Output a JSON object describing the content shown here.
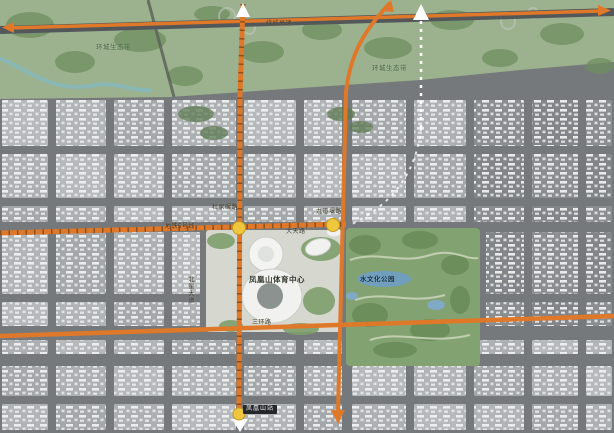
{
  "map": {
    "region_labels": {
      "eco_belt_west": "环城生态带",
      "eco_belt_east": "环城生态带",
      "sports_center": "凤凰山体育中心",
      "culture_park": "水文化公园"
    },
    "road_labels": {
      "ring_expressway": "绕城高速",
      "dujianian_road": "杜家碾路",
      "jiudaoyan_road": "九道堰路",
      "datian_road": "大天路",
      "beixing_avenue": "北星大道",
      "sanhuan_road": "三环路",
      "metro_line_5": "地铁5号线"
    },
    "station_label": "凤凰山站",
    "colors": {
      "arterial_orange": "#e0782a",
      "eco_belt_green": "#9cb28e",
      "park_green": "#82a371",
      "water_blue": "#6f9ec0",
      "station_yellow": "#eec73e",
      "street_gray": "#75797b",
      "block_gray": "#b1b4b6",
      "building_white": "#f0f1f1"
    }
  }
}
